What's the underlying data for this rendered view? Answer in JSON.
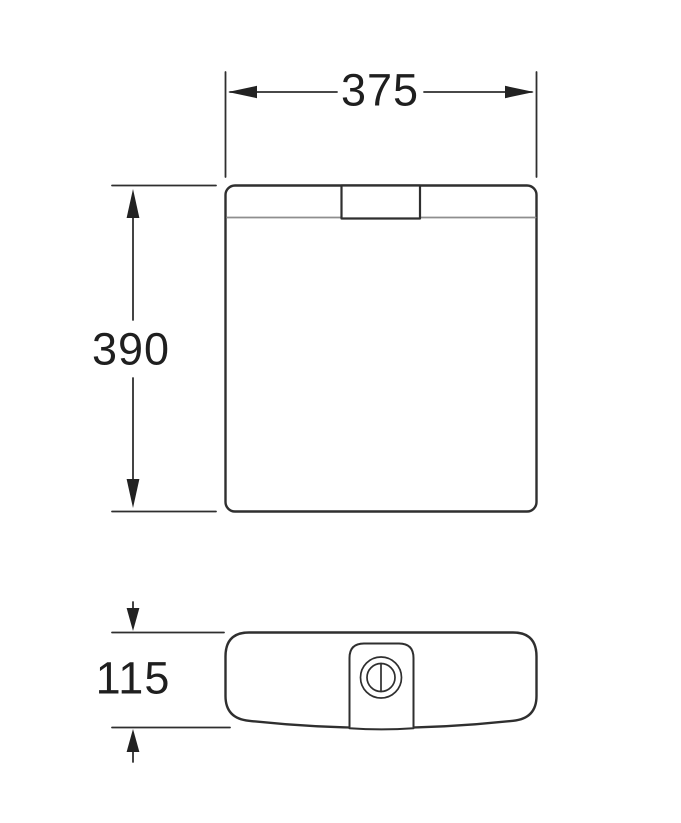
{
  "diagram": {
    "type": "technical-dimension-drawing",
    "subject": "toilet-cistern-front-and-top-view",
    "labels": {
      "width": "375",
      "height": "390",
      "depth": "115"
    },
    "colors": {
      "line": "#2f2f2f",
      "lid_line": "#8e8e8e",
      "background": "#ffffff",
      "text": "#1f1f1f"
    }
  }
}
